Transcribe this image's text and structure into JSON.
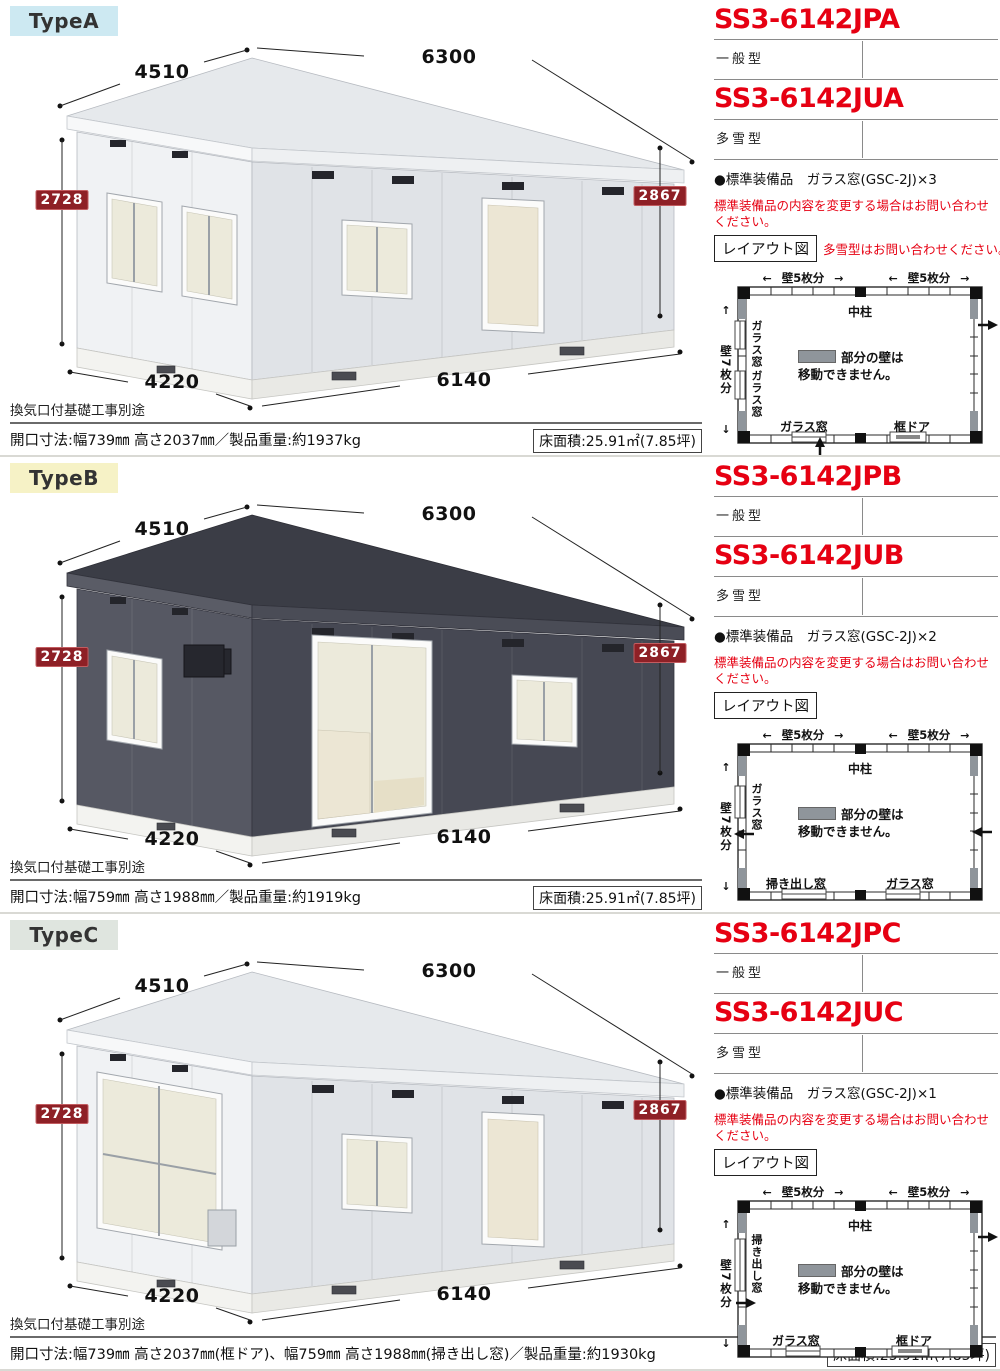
{
  "colors": {
    "accent_red": "#e60012",
    "badge_red": "#8e2026",
    "tab_a_bg": "#cde9f2",
    "tab_b_bg": "#f6f2c6",
    "tab_c_bg": "#dfe5df"
  },
  "sections": [
    {
      "tab": "TypeA",
      "codes": [
        {
          "code": "SS3-6142JPA",
          "type": "一般型"
        },
        {
          "code": "SS3-6142JUA",
          "type": "多雪型"
        }
      ],
      "equipment": "●標準装備品　ガラス窓(GSC-2J)×3",
      "warning": "標準装備品の内容を変更する場合はお問い合わせください。",
      "layout_button": "レイアウト図",
      "layout_note": "多雪型はお問い合わせください。",
      "dims": {
        "top_left": "4510",
        "top_right": "6300",
        "left": "2728",
        "right": "2867",
        "bottom_left": "4220",
        "bottom_right": "6140"
      },
      "notes": {
        "foundation": "換気口付基礎工事別途",
        "spec": "開口寸法:幅739㎜ 高さ2037㎜／製品重量:約1937kg",
        "floor_area": "床面積:25.91㎡(7.85坪)"
      },
      "plan": {
        "top_dim1": "壁5枚分",
        "top_dim2": "壁5枚分",
        "left_dim": "壁7枚分",
        "pillar": "中柱",
        "legend_line1": "部分の壁は",
        "legend_line2": "移動できません。",
        "left_labels": [
          "ガラス窓",
          "ガラス窓"
        ],
        "bottom_labels": [
          "ガラス窓",
          "框ドア"
        ]
      }
    },
    {
      "tab": "TypeB",
      "codes": [
        {
          "code": "SS3-6142JPB",
          "type": "一般型"
        },
        {
          "code": "SS3-6142JUB",
          "type": "多雪型"
        }
      ],
      "equipment": "●標準装備品　ガラス窓(GSC-2J)×2",
      "warning": "標準装備品の内容を変更する場合はお問い合わせください。",
      "layout_button": "レイアウト図",
      "dims": {
        "top_left": "4510",
        "top_right": "6300",
        "left": "2728",
        "right": "2867",
        "bottom_left": "4220",
        "bottom_right": "6140"
      },
      "notes": {
        "foundation": "換気口付基礎工事別途",
        "spec": "開口寸法:幅759㎜ 高さ1988㎜／製品重量:約1919kg",
        "floor_area": "床面積:25.91㎡(7.85坪)"
      },
      "plan": {
        "top_dim1": "壁5枚分",
        "top_dim2": "壁5枚分",
        "left_dim": "壁7枚分",
        "pillar": "中柱",
        "legend_line1": "部分の壁は",
        "legend_line2": "移動できません。",
        "left_labels": [
          "ガラス窓"
        ],
        "bottom_labels": [
          "掃き出し窓",
          "ガラス窓"
        ]
      }
    },
    {
      "tab": "TypeC",
      "codes": [
        {
          "code": "SS3-6142JPC",
          "type": "一般型"
        },
        {
          "code": "SS3-6142JUC",
          "type": "多雪型"
        }
      ],
      "equipment": "●標準装備品　ガラス窓(GSC-2J)×1",
      "warning": "標準装備品の内容を変更する場合はお問い合わせください。",
      "layout_button": "レイアウト図",
      "dims": {
        "top_left": "4510",
        "top_right": "6300",
        "left": "2728",
        "right": "2867",
        "bottom_left": "4220",
        "bottom_right": "6140"
      },
      "notes": {
        "foundation": "換気口付基礎工事別途",
        "spec": "開口寸法:幅739㎜ 高さ2037㎜(框ドア)、幅759㎜ 高さ1988㎜(掃き出し窓)／製品重量:約1930kg",
        "floor_area": "床面積:25.91㎡(7.85坪)"
      },
      "plan": {
        "top_dim1": "壁5枚分",
        "top_dim2": "壁5枚分",
        "left_dim": "壁7枚分",
        "pillar": "中柱",
        "legend_line1": "部分の壁は",
        "legend_line2": "移動できません。",
        "left_labels": [
          "掃き出し窓"
        ],
        "bottom_labels": [
          "ガラス窓",
          "框ドア"
        ]
      }
    }
  ]
}
